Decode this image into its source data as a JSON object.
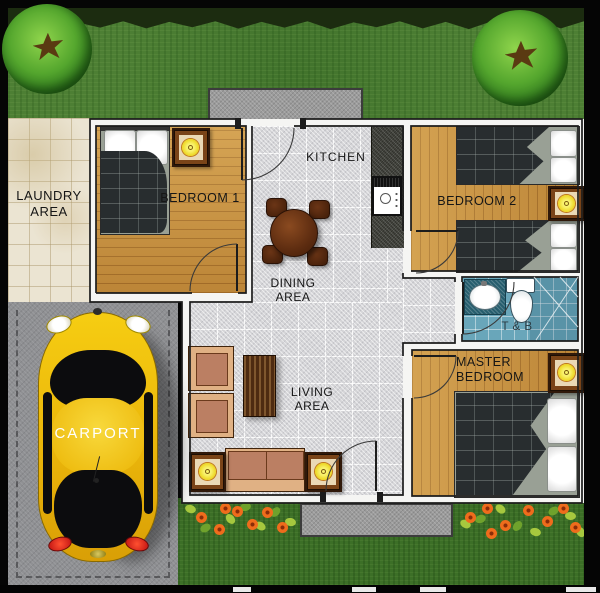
{
  "plan_title": "Bungalow House Floor Plan",
  "rooms": {
    "laundry": {
      "line1": "LAUNDRY",
      "line2": "AREA"
    },
    "bedroom1": {
      "name": "BEDROOM 1"
    },
    "kitchen": {
      "name": "KITCHEN"
    },
    "dining": {
      "line1": "DINING",
      "line2": "AREA"
    },
    "bedroom2": {
      "name": "BEDROOM 2"
    },
    "toilet_bath": {
      "name": "T & B"
    },
    "living": {
      "line1": "LIVING",
      "line2": "AREA"
    },
    "master_bedroom": {
      "line1": "MASTER",
      "line2": "BEDROOM"
    },
    "carport": {
      "name": "CARPORT"
    }
  },
  "colors": {
    "wood_floor": "#c8923f",
    "tile_gray": "#d4d4d7",
    "laundry_tile": "#ebe4d2",
    "bath_blue": "#69a6ba",
    "grass": "#4d7f34",
    "car_yellow": "#f2c712",
    "lamp_yellow": "#eed928",
    "flower_orange": "#ef6c1c",
    "wall_white": "#f5f5f3",
    "counter_granite": "#45463f"
  }
}
